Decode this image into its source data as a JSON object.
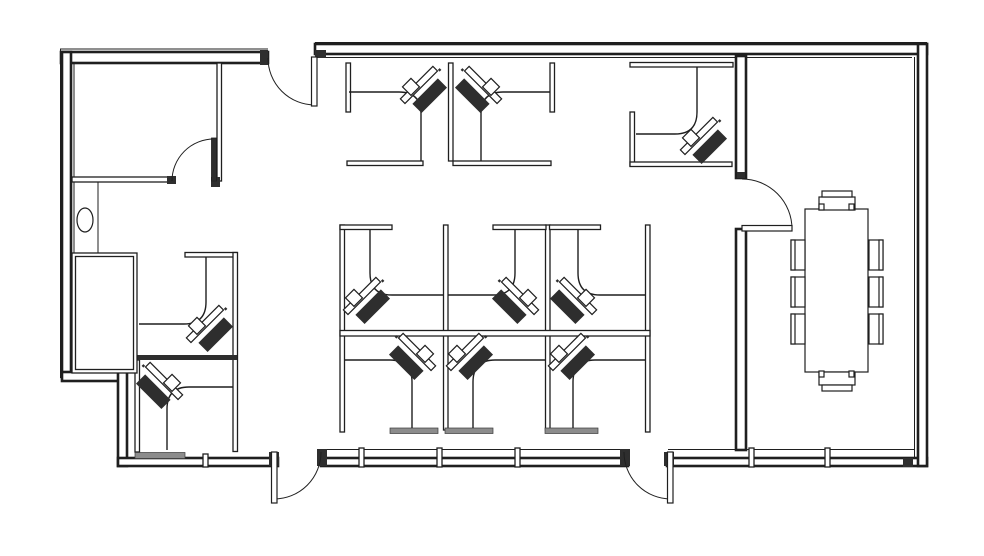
{
  "title": "Office floor plan drawing",
  "canvas": {
    "w": 984,
    "h": 556,
    "bg": "#ffffff",
    "ink": "#1f1f1f",
    "gray": "#8c8c8c",
    "dark": "#2e2e2e"
  },
  "plan": {
    "thin_lines": [
      {
        "name": "top-wall-outer-line",
        "x1": 315,
        "y1": 42.5,
        "x2": 927,
        "y2": 42.5
      },
      {
        "name": "top-wall-inner-line",
        "x1": 318,
        "y1": 57.5,
        "x2": 912,
        "y2": 57.5
      },
      {
        "name": "top-left-wall-outer-line",
        "x1": 60,
        "y1": 49,
        "x2": 268,
        "y2": 49
      },
      {
        "name": "left-wall-outer-line",
        "x1": 60.5,
        "y1": 49,
        "x2": 60.5,
        "y2": 378
      },
      {
        "name": "left-wall-inner-line",
        "x1": 74,
        "y1": 64,
        "x2": 74,
        "y2": 253
      },
      {
        "name": "right-wall-inner-line",
        "x1": 914.5,
        "y1": 57,
        "x2": 914.5,
        "y2": 458
      },
      {
        "name": "alcove-partition-line",
        "x1": 98,
        "y1": 182,
        "x2": 98,
        "y2": 253
      },
      {
        "name": "window-wall-mid-inner-line",
        "x1": 322,
        "y1": 449.5,
        "x2": 627,
        "y2": 449.5
      },
      {
        "name": "window-wall-right-inner-line",
        "x1": 668,
        "y1": 449.5,
        "x2": 914,
        "y2": 449.5
      }
    ],
    "wall_bands": [
      {
        "name": "top-wall",
        "x": 315,
        "y": 44,
        "w": 612,
        "h": 10
      },
      {
        "name": "top-left-wall",
        "x": 61,
        "y": 52,
        "w": 207,
        "h": 11
      },
      {
        "name": "left-wall",
        "x": 62,
        "y": 52,
        "w": 9,
        "h": 326
      },
      {
        "name": "step-wall-horizontal",
        "x": 62,
        "y": 372,
        "w": 64,
        "h": 9
      },
      {
        "name": "step-wall-vertical",
        "x": 118,
        "y": 372,
        "w": 9,
        "h": 94
      },
      {
        "name": "bottom-wall-left",
        "x": 118,
        "y": 458,
        "w": 160,
        "h": 8
      },
      {
        "name": "bottom-wall-mid",
        "x": 321,
        "y": 458,
        "w": 307,
        "h": 8
      },
      {
        "name": "bottom-wall-right",
        "x": 667,
        "y": 458,
        "w": 260,
        "h": 8
      },
      {
        "name": "right-wall",
        "x": 918,
        "y": 44,
        "w": 9,
        "h": 422
      },
      {
        "name": "conference-west-wall-upper",
        "x": 736,
        "y": 56,
        "w": 10,
        "h": 122
      },
      {
        "name": "conference-west-wall-lower",
        "x": 736,
        "y": 229,
        "w": 10,
        "h": 221
      }
    ],
    "partitions": [
      {
        "name": "room1-south-wall",
        "x": 72,
        "y": 177,
        "w": 100,
        "h": 5
      },
      {
        "name": "room1-east-wall",
        "x": 217,
        "y": 63,
        "w": 4.5,
        "h": 118
      },
      {
        "name": "cubicleA-left-partition",
        "x": 346,
        "y": 63,
        "w": 4.5,
        "h": 49
      },
      {
        "name": "cubicleAB-shared-partition",
        "x": 448.5,
        "y": 63,
        "w": 4.5,
        "h": 98
      },
      {
        "name": "cubicleB-right-partition",
        "x": 550,
        "y": 63,
        "w": 4.5,
        "h": 49
      },
      {
        "name": "cubicleA-bottom-partition",
        "x": 347,
        "y": 161,
        "w": 76,
        "h": 4.5
      },
      {
        "name": "cubicleB-bottom-partition",
        "x": 453,
        "y": 161,
        "w": 98,
        "h": 4.5
      },
      {
        "name": "cubicleC-top-partition",
        "x": 630,
        "y": 62.5,
        "w": 103,
        "h": 4.5
      },
      {
        "name": "cubicleC-left-partition",
        "x": 630,
        "y": 112,
        "w": 4.5,
        "h": 54
      },
      {
        "name": "cubicleC-bottom-partition",
        "x": 630,
        "y": 162,
        "w": 102,
        "h": 4.5
      },
      {
        "name": "cubicleD-top-partition",
        "x": 185,
        "y": 252.5,
        "w": 52,
        "h": 4.5
      },
      {
        "name": "cubicleDE-east-partition",
        "x": 233,
        "y": 252.5,
        "w": 4.5,
        "h": 199
      },
      {
        "name": "cubicleE-left-partition",
        "x": 135,
        "y": 360,
        "w": 4.5,
        "h": 92
      },
      {
        "name": "block-west-partition",
        "x": 340,
        "y": 225,
        "w": 4.5,
        "h": 207
      },
      {
        "name": "block-shared-partition-1",
        "x": 443.5,
        "y": 225,
        "w": 4.5,
        "h": 205
      },
      {
        "name": "block-shared-partition-2",
        "x": 545.5,
        "y": 225,
        "w": 4.5,
        "h": 205
      },
      {
        "name": "block-east-partition",
        "x": 645.5,
        "y": 225,
        "w": 4.5,
        "h": 207
      },
      {
        "name": "block-middle-divider",
        "x": 340,
        "y": 330.5,
        "w": 310,
        "h": 5.5
      },
      {
        "name": "cubicle1-top-partition",
        "x": 340,
        "y": 225,
        "w": 52,
        "h": 4.5
      },
      {
        "name": "cubicle2-top-partition",
        "x": 493,
        "y": 225,
        "w": 53,
        "h": 4.5
      },
      {
        "name": "cubicle3-top-partition",
        "x": 549.5,
        "y": 225,
        "w": 51,
        "h": 4.5
      },
      {
        "name": "window-mullion-1",
        "x": 203,
        "y": 454,
        "w": 5,
        "h": 13
      },
      {
        "name": "window-mullion-2",
        "x": 359,
        "y": 448,
        "w": 5,
        "h": 19
      },
      {
        "name": "window-mullion-3",
        "x": 437,
        "y": 448,
        "w": 5,
        "h": 19
      },
      {
        "name": "window-mullion-4",
        "x": 515,
        "y": 448,
        "w": 5,
        "h": 19
      },
      {
        "name": "window-mullion-5",
        "x": 749,
        "y": 448,
        "w": 5,
        "h": 19
      },
      {
        "name": "window-mullion-6",
        "x": 825,
        "y": 448,
        "w": 5,
        "h": 19
      }
    ],
    "solid_rects": [
      {
        "name": "cubicleDE-divider-bar",
        "x": 136,
        "y": 355,
        "w": 101,
        "h": 5,
        "cls": "solid"
      },
      {
        "name": "cubicle4-bottom-bar",
        "x": 390,
        "y": 428,
        "w": 48,
        "h": 5.5,
        "cls": "grayfill"
      },
      {
        "name": "cubicle5-bottom-bar",
        "x": 445,
        "y": 428,
        "w": 48,
        "h": 5.5,
        "cls": "grayfill"
      },
      {
        "name": "cubicle6-bottom-bar",
        "x": 545,
        "y": 428,
        "w": 53,
        "h": 5.5,
        "cls": "grayfill"
      },
      {
        "name": "cubicleE-bottom-bar",
        "x": 135,
        "y": 452.5,
        "w": 50,
        "h": 6,
        "cls": "grayfill"
      },
      {
        "name": "top-door-jamb-left",
        "x": 260,
        "y": 50,
        "w": 8,
        "h": 15,
        "cls": "solid"
      },
      {
        "name": "top-door-jamb-right",
        "x": 315,
        "y": 50,
        "w": 11,
        "h": 8,
        "cls": "solid"
      },
      {
        "name": "room1-door-jamb",
        "x": 167,
        "y": 176,
        "w": 9,
        "h": 8,
        "cls": "solid"
      },
      {
        "name": "room1-door-hinge-jamb",
        "x": 211,
        "y": 177,
        "w": 9,
        "h": 10,
        "cls": "solid"
      },
      {
        "name": "bottom-left-door-jamb-a",
        "x": 269,
        "y": 452,
        "w": 10,
        "h": 14,
        "cls": "solid"
      },
      {
        "name": "bottom-left-door-jamb-b",
        "x": 317,
        "y": 449,
        "w": 10,
        "h": 17,
        "cls": "solid"
      },
      {
        "name": "bottom-right-door-jamb-a",
        "x": 620,
        "y": 449,
        "w": 10,
        "h": 17,
        "cls": "solid"
      },
      {
        "name": "bottom-right-door-jamb-b",
        "x": 664,
        "y": 452,
        "w": 10,
        "h": 14,
        "cls": "solid"
      },
      {
        "name": "bottom-right-corner-nub",
        "x": 903,
        "y": 458,
        "w": 10,
        "h": 9,
        "cls": "solid"
      },
      {
        "name": "conference-wall-cap",
        "x": 737,
        "y": 172,
        "w": 8,
        "h": 6,
        "cls": "solid"
      }
    ],
    "desks": [
      {
        "name": "desk-cubicleA",
        "d": "M349 92 H399 Q421 92 421 114 V161"
      },
      {
        "name": "desk-cubicleB",
        "d": "M550 92 H503 Q481 92 481 114 V161"
      },
      {
        "name": "desk-cubicleC",
        "d": "M697 67 V112 Q697 134 675 134 H636"
      },
      {
        "name": "desk-cubicleD",
        "d": "M206 257 V302 Q206 324 184 324 H139"
      },
      {
        "name": "desk-cubicleE",
        "d": "M233 387 H189 Q167 387 167 409 V450"
      },
      {
        "name": "desk-cubicle1",
        "d": "M370 229 V273 Q370 295 392 295 H443"
      },
      {
        "name": "desk-cubicle2",
        "d": "M515 229 V273 Q515 295 493 295 H448"
      },
      {
        "name": "desk-cubicle3",
        "d": "M578 229 V273 Q578 295 600 295 H645"
      },
      {
        "name": "desk-cubicle4",
        "d": "M345 360 H390 Q412 360 412 382 V428"
      },
      {
        "name": "desk-cubicle5",
        "d": "M545 360 H495 Q473 360 473 382 V428"
      },
      {
        "name": "desk-cubicle6",
        "d": "M645 360 H595 Q573 360 573 382 V428"
      }
    ],
    "door_arcs": [
      {
        "name": "top-entry-door-swing",
        "d": "M268 58 A47 47 0 0 0 315 105"
      },
      {
        "name": "room1-door-swing",
        "d": "M172 181 A42 42 0 0 1 214 139"
      },
      {
        "name": "bottom-left-door-swing",
        "d": "M321 452 A47 47 0 0 1 274 499"
      },
      {
        "name": "bottom-right-door-swing",
        "d": "M624 452 A47 47 0 0 0 671 499"
      },
      {
        "name": "conference-door-swing",
        "d": "M742 179 A50 50 0 0 1 792 229"
      }
    ],
    "door_leaves": [
      {
        "name": "top-entry-door-leaf",
        "x": 311.5,
        "y": 57,
        "w": 5.5,
        "h": 49,
        "dark": false
      },
      {
        "name": "room1-door-leaf",
        "x": 211.5,
        "y": 138,
        "w": 5,
        "h": 43,
        "dark": true
      },
      {
        "name": "bottom-left-door-leaf",
        "x": 271.5,
        "y": 452,
        "w": 5.5,
        "h": 51,
        "dark": false
      },
      {
        "name": "bottom-right-door-leaf",
        "x": 667.5,
        "y": 452,
        "w": 5.5,
        "h": 51,
        "dark": false
      },
      {
        "name": "conference-door-leaf",
        "x": 742,
        "y": 225.5,
        "w": 50,
        "h": 5.5,
        "dark": false
      }
    ],
    "storage_room": {
      "name": "storage-room",
      "outer": {
        "x": 72,
        "y": 253,
        "w": 65,
        "h": 120
      },
      "inner": {
        "x": 75.5,
        "y": 256.5,
        "w": 58,
        "h": 113
      }
    },
    "wall_ellipse": {
      "name": "wall-fixture-ellipse",
      "cx": 85,
      "cy": 220,
      "rx": 8,
      "ry": 12
    },
    "workstations": [
      {
        "name": "workstation-chair-A",
        "cx": 423,
        "cy": 89,
        "mirror": false
      },
      {
        "name": "workstation-chair-B",
        "cx": 479,
        "cy": 89,
        "mirror": true
      },
      {
        "name": "workstation-chair-C",
        "cx": 703,
        "cy": 140,
        "mirror": false
      },
      {
        "name": "workstation-chair-D",
        "cx": 209,
        "cy": 328,
        "mirror": false
      },
      {
        "name": "workstation-chair-E",
        "cx": 160,
        "cy": 385,
        "mirror": true
      },
      {
        "name": "workstation-chair-1",
        "cx": 366,
        "cy": 300,
        "mirror": false
      },
      {
        "name": "workstation-chair-2",
        "cx": 516,
        "cy": 300,
        "mirror": true
      },
      {
        "name": "workstation-chair-3",
        "cx": 574,
        "cy": 300,
        "mirror": true
      },
      {
        "name": "workstation-chair-4",
        "cx": 413,
        "cy": 356,
        "mirror": true
      },
      {
        "name": "workstation-chair-5",
        "cx": 469,
        "cy": 356,
        "mirror": false
      },
      {
        "name": "workstation-chair-6",
        "cx": 571,
        "cy": 356,
        "mirror": false
      }
    ],
    "conference": {
      "table": {
        "name": "conference-table",
        "x": 805,
        "y": 209,
        "w": 63,
        "h": 163
      },
      "end_chairs": [
        {
          "name": "conference-chair-north",
          "seat": {
            "x": 819,
            "y": 197,
            "w": 36,
            "h": 13
          },
          "back": {
            "x": 822,
            "y": 191,
            "w": 30,
            "h": 6
          },
          "nubs": [
            {
              "x": 819,
              "y": 204,
              "w": 5,
              "h": 6
            },
            {
              "x": 849,
              "y": 204,
              "w": 5,
              "h": 6
            }
          ]
        },
        {
          "name": "conference-chair-south",
          "seat": {
            "x": 819,
            "y": 372,
            "w": 36,
            "h": 13
          },
          "back": {
            "x": 822,
            "y": 385,
            "w": 30,
            "h": 6
          },
          "nubs": [
            {
              "x": 819,
              "y": 371,
              "w": 5,
              "h": 6
            },
            {
              "x": 849,
              "y": 371,
              "w": 5,
              "h": 6
            }
          ]
        }
      ],
      "side_chair_ys": [
        240,
        277,
        314
      ],
      "left_chair": {
        "x": 791,
        "w": 14,
        "h": 30,
        "back_x": 791,
        "back_w": 4
      },
      "right_chair": {
        "x": 869,
        "w": 14,
        "h": 30,
        "back_x": 879,
        "back_w": 4
      }
    }
  }
}
